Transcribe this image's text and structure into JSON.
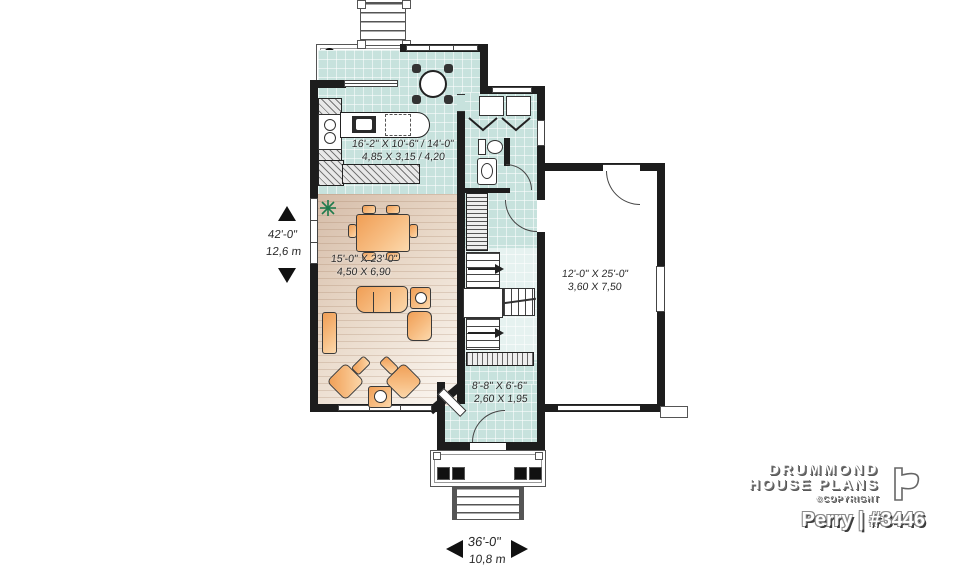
{
  "branding": {
    "line1": "DRUMMOND",
    "line2": "HOUSE PLANS",
    "copyright": "©COPYRIGHT",
    "plan_name": "Perry | #3446"
  },
  "dimensions": {
    "height": {
      "imperial": "42'-0\"",
      "metric": "12,6 m"
    },
    "width": {
      "imperial": "36'-0\"",
      "metric": "10,8 m"
    }
  },
  "rooms": {
    "kitchen": {
      "imperial": "16'-2\" X 10'-6\" / 14'-0\"",
      "metric": "4,85 X 3,15 / 4,20"
    },
    "living": {
      "imperial": "15'-0\" X 23'-0\"",
      "metric": "4,50 X 6,90"
    },
    "garage": {
      "imperial": "12'-0\" X 25'-0\"",
      "metric": "3,60 X 7,50"
    },
    "entry": {
      "imperial": "8'-8\" X 6'-6\"",
      "metric": "2,60 X 1,95"
    }
  },
  "colors": {
    "wall": "#1d1d1d",
    "tile": "#c7e2dd",
    "wood_dark": "#d5bca8",
    "wood_light": "#faf6f0",
    "furniture": "#f5ab62",
    "plant_green": "#1e7b4d"
  }
}
